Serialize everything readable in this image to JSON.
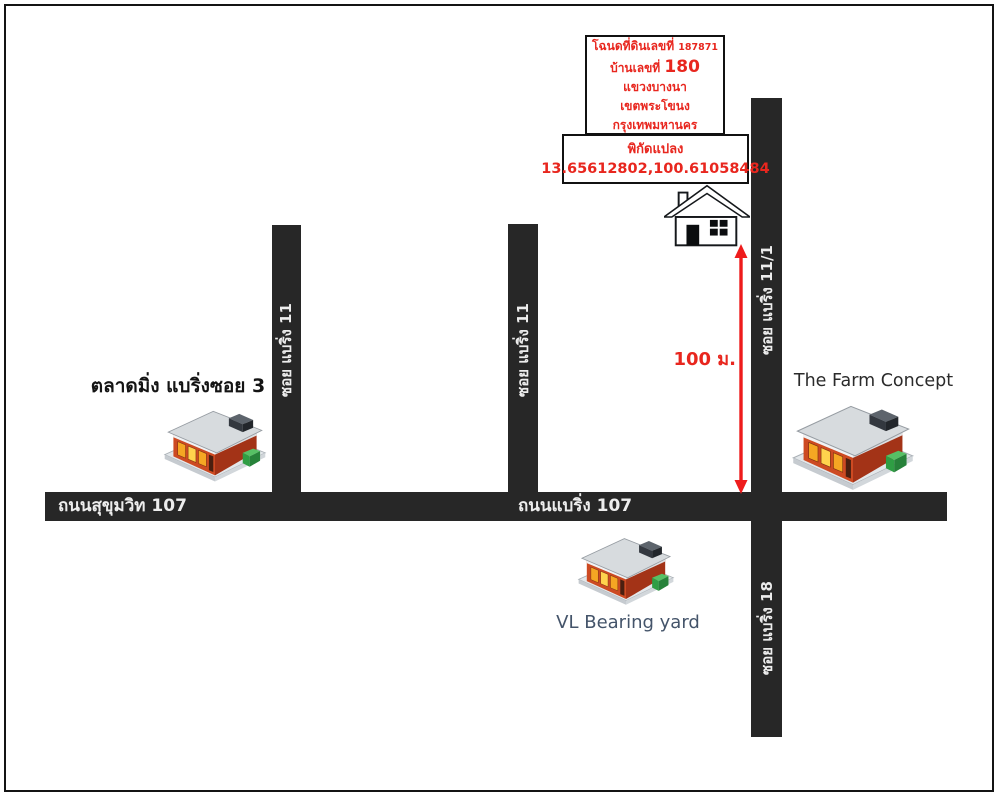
{
  "deed_box": {
    "line1_prefix": "โฉนดที่ดินเลขที่",
    "line1_number": "187871",
    "line2_prefix": "บ้านเลขที่",
    "line2_number": "180",
    "line3": "แขวงบางนา",
    "line4": "เขตพระโขนง",
    "line5": "กรุงเทพมหานคร"
  },
  "coords_box": {
    "title": "พิกัดแปลง",
    "value": "13.65612802,100.61058484"
  },
  "distance": {
    "label": "100 ม."
  },
  "roads": {
    "soi11_left": "ซอย แบริ่ง 11",
    "soi11_mid": "ซอย แบริ่ง 11",
    "soi11_1": "ซอย แบริ่ง 11/1",
    "soi18": "ซอย แบริ่ง 18",
    "sukhumvit107": "ถนนสุขุมวิท 107",
    "bearing107": "ถนนแบริ่ง 107"
  },
  "places": {
    "market": "ตลาดมิ่ง แบริ่งซอย 3",
    "farm": "The Farm Concept",
    "yard": "VL Bearing yard"
  },
  "colors": {
    "road": "#272727",
    "road_text": "#ededed",
    "accent_red": "#e8261e",
    "yard_label": "#44546a"
  }
}
